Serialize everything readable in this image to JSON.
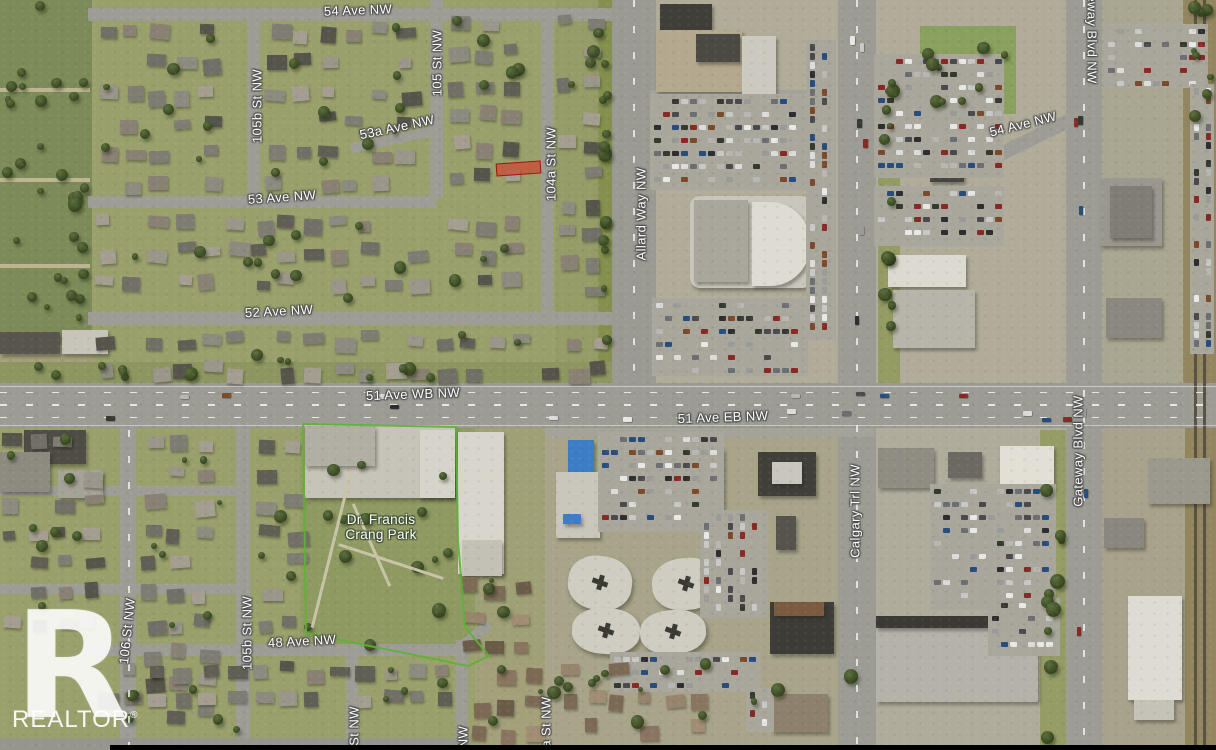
{
  "map": {
    "type": "aerial-satellite",
    "road_labels": [
      {
        "text": "54 Ave NW",
        "cx": 358,
        "cy": 10,
        "rot": -2
      },
      {
        "text": "105b St NW",
        "cx": 257,
        "cy": 106,
        "rot": -90
      },
      {
        "text": "105 St NW",
        "cx": 437,
        "cy": 63,
        "rot": -90
      },
      {
        "text": "53a Ave NW",
        "cx": 397,
        "cy": 127,
        "rot": -12
      },
      {
        "text": "104a St NW",
        "cx": 551,
        "cy": 164,
        "rot": -90
      },
      {
        "text": "53 Ave NW",
        "cx": 282,
        "cy": 197,
        "rot": -4
      },
      {
        "text": "52 Ave NW",
        "cx": 279,
        "cy": 311,
        "rot": -3
      },
      {
        "text": "Allard Way NW",
        "cx": 641,
        "cy": 214,
        "rot": -90
      },
      {
        "text": "51 Ave WB NW",
        "cx": 413,
        "cy": 394,
        "rot": -2
      },
      {
        "text": "51 Ave EB NW",
        "cx": 723,
        "cy": 417,
        "rot": -2
      },
      {
        "text": "54 Ave NW",
        "cx": 1023,
        "cy": 124,
        "rot": -14
      },
      {
        "text": "Gateway Blvd NW",
        "cx": 1092,
        "cy": 28,
        "rot": 90
      },
      {
        "text": "Gateway Blvd NW",
        "cx": 1078,
        "cy": 451,
        "rot": -90
      },
      {
        "text": "Calgary Trl NW",
        "cx": 855,
        "cy": 511,
        "rot": -90
      },
      {
        "text": "106 St NW",
        "cx": 127,
        "cy": 631,
        "rot": -84
      },
      {
        "text": "105b St NW",
        "cx": 247,
        "cy": 633,
        "rot": -90
      },
      {
        "text": "48 Ave NW",
        "cx": 302,
        "cy": 641,
        "rot": -3
      },
      {
        "text": "St NW",
        "cx": 354,
        "cy": 726,
        "rot": -90
      },
      {
        "text": "NW",
        "cx": 463,
        "cy": 737,
        "rot": -90
      },
      {
        "text": "a St NW",
        "cx": 546,
        "cy": 722,
        "rot": -90
      }
    ],
    "poi_labels": [
      {
        "lines": [
          "Dr. Francis",
          "Crang Park"
        ],
        "cx": 381,
        "cy": 527
      }
    ],
    "highlight_parcel": {
      "x": 496,
      "y": 162,
      "w": 45,
      "h": 13,
      "rot": -4
    },
    "watermark": {
      "logo_letter": "R",
      "text": "REALTOR",
      "registered": "®"
    },
    "colors": {
      "label_text": "#ffffff",
      "label_halo": "#4a4a4c",
      "parcel_fill": "rgba(219,44,32,0.55)",
      "parcel_border": "#a31510",
      "park_boundary": "#5cb335",
      "watermark": "#ffffff",
      "bottom_bar": "#000000"
    }
  }
}
